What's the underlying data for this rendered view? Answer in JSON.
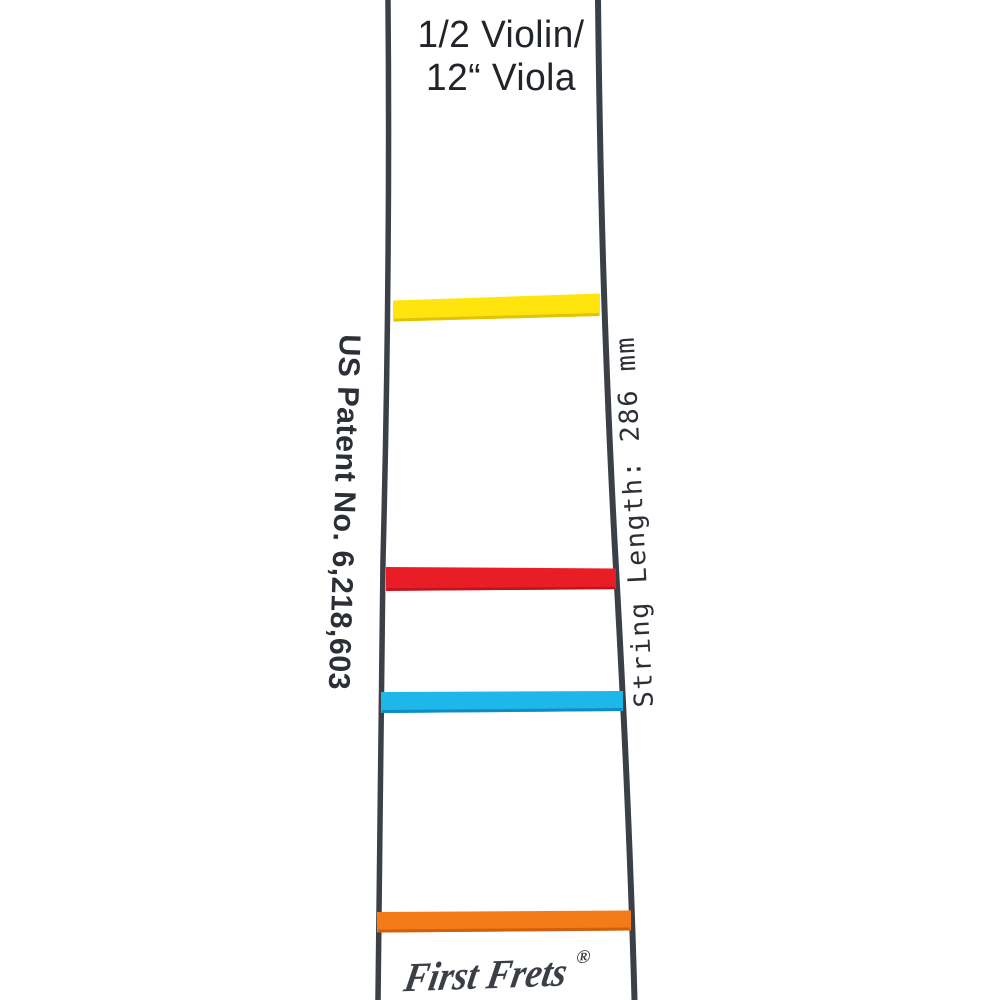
{
  "product": {
    "size_label_line1": "1/2 Violin/",
    "size_label_line2": "12“ Viola",
    "patent_label": "US Patent No. 6,218,603",
    "string_length_label": "String Length: 286 mm",
    "brand": "First Frets",
    "registered_mark": "®"
  },
  "colors": {
    "background": "#ffffff",
    "board_edge": "#3b3f46",
    "title_text": "#212429",
    "side_text": "#2c3036",
    "logo_text": "#3a3e45"
  },
  "tapes": [
    {
      "name": "yellow",
      "color": "#ffe40e",
      "edge_color": "#e0c403"
    },
    {
      "name": "red",
      "color": "#e91d26",
      "edge_color": "#bf141d"
    },
    {
      "name": "blue",
      "color": "#1eb7ea",
      "edge_color": "#0f8cc4"
    },
    {
      "name": "orange",
      "color": "#f57a18",
      "edge_color": "#d0600c"
    }
  ]
}
